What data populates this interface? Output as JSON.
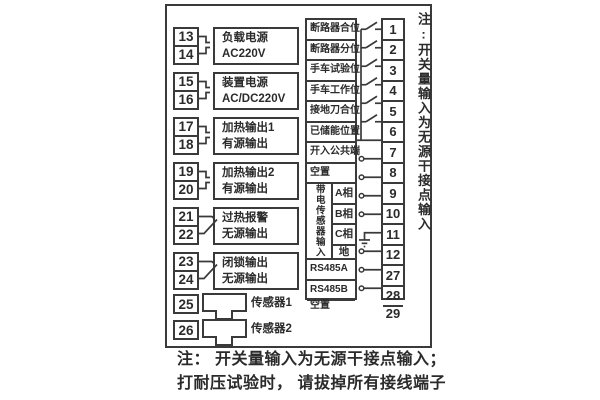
{
  "diagram": {
    "left_groups": [
      {
        "terminals": [
          "13",
          "14"
        ],
        "label_lines": [
          "负载电源",
          "AC220V"
        ],
        "connector": "plug"
      },
      {
        "terminals": [
          "15",
          "16"
        ],
        "label_lines": [
          "装置电源",
          "AC/DC220V"
        ],
        "connector": "plug"
      },
      {
        "terminals": [
          "17",
          "18"
        ],
        "label_lines": [
          "加热输出1",
          "有源输出"
        ],
        "connector": "plug"
      },
      {
        "terminals": [
          "19",
          "20"
        ],
        "label_lines": [
          "加热输出2",
          "有源输出"
        ],
        "connector": "plug"
      },
      {
        "terminals": [
          "21",
          "22"
        ],
        "label_lines": [
          "过热报警",
          "无源输出"
        ],
        "connector": "contact"
      },
      {
        "terminals": [
          "23",
          "24"
        ],
        "label_lines": [
          "闭锁输出",
          "无源输出"
        ],
        "connector": "contact"
      }
    ],
    "sensors": [
      {
        "terminal": "25",
        "label": "传感器1"
      },
      {
        "terminal": "26",
        "label": "传感器2"
      }
    ],
    "right_rows": [
      {
        "terminal": "1",
        "label": "断路器合位",
        "symbol": "switch"
      },
      {
        "terminal": "2",
        "label": "断路器分位",
        "symbol": "switch"
      },
      {
        "terminal": "3",
        "label": "手车试验位",
        "symbol": "switch"
      },
      {
        "terminal": "4",
        "label": "手车工作位",
        "symbol": "switch"
      },
      {
        "terminal": "5",
        "label": "接地刀合位",
        "symbol": "switch"
      },
      {
        "terminal": "6",
        "label": "已储能位置",
        "symbol": "switch"
      },
      {
        "terminal": "7",
        "label": "开入公共端",
        "symbol": "common"
      },
      {
        "terminal": "8",
        "label": "空置",
        "symbol": "open"
      },
      {
        "terminal": "9",
        "label": "A相",
        "symbol": "open",
        "group": "sensor"
      },
      {
        "terminal": "10",
        "label": "B相",
        "symbol": "open",
        "group": "sensor"
      },
      {
        "terminal": "11",
        "label": "C相",
        "symbol": "open",
        "group": "sensor"
      },
      {
        "terminal": "12",
        "label": "地",
        "symbol": "ground",
        "group": "sensor"
      },
      {
        "terminal": "27",
        "label": "RS485A",
        "symbol": "open"
      },
      {
        "terminal": "28",
        "label": "RS485B",
        "symbol": "open"
      },
      {
        "terminal": "29",
        "label": "空置",
        "symbol": "open"
      }
    ],
    "sensor_group_label": "带电传感器输入",
    "side_note": "注:开关量输入为无源干接点输入",
    "bottom_note_lines": [
      "注： 开关量输入为无源干接点输入；",
      "打耐压试验时， 请拔掉所有接线端子"
    ],
    "colors": {
      "line": "#3a3a3a",
      "text": "#2b2b2b",
      "background": "#ffffff"
    }
  }
}
